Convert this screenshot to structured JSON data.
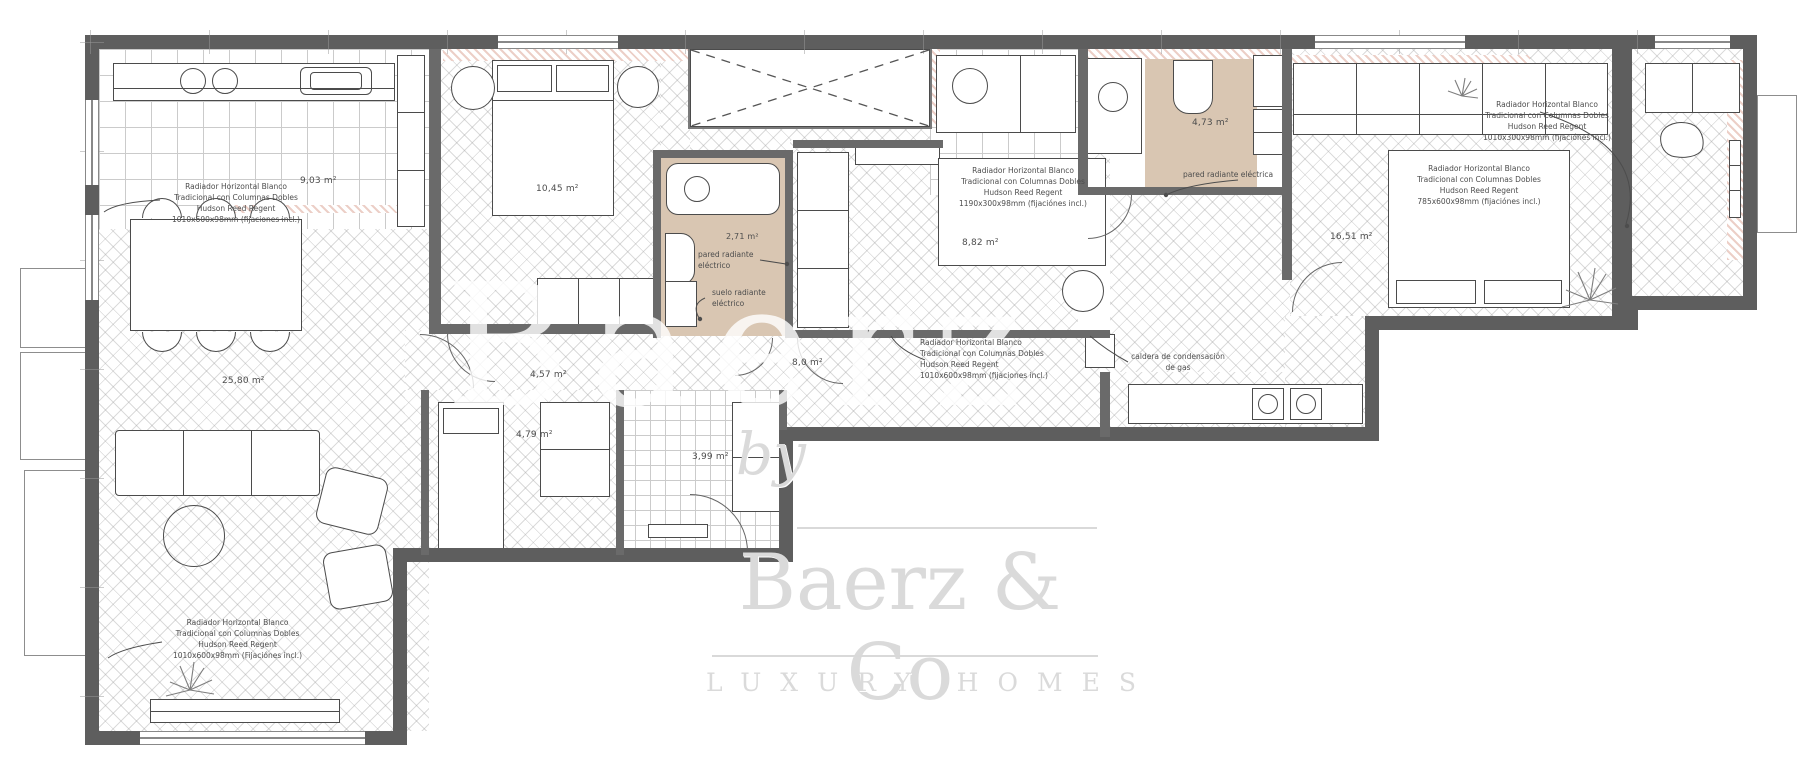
{
  "watermark": {
    "by": "by",
    "name": "Baerz & Co",
    "tagline": "LUXURY HOMES"
  },
  "colors": {
    "wall": "#5e5e5e",
    "bath_floor": "#d9c6b2",
    "new_wall_hatch": "#eccfc7",
    "floor_line": "#cbcbcb",
    "watermark": "#d9d9d9"
  },
  "rooms": {
    "kitchen": {
      "area": "9,03 m²",
      "radiator": "Radiador Horizontal Blanco\nTradicional con Columnas Dobles\nHudson Reed Regent\n1010x600x98mm (fijaciones incl.)"
    },
    "living_room": {
      "area": "25,80 m²",
      "radiator": "Radiador Horizontal Blanco\nTradicional con Columnas Dobles\nHudson Reed Regent\n1010x600x98mm (Fijaciónes incl.)"
    },
    "bedroom_1": {
      "area": "10,45 m²"
    },
    "bathroom_1": {
      "area": "2,71 m²",
      "wall_heating": "pared radiante\neléctrico",
      "floor_heating": "suelo radiante\neléctrico"
    },
    "bedroom_2": {
      "area": "8,82 m²",
      "radiator": "Radiador Horizontal Blanco\nTradicional con Columnas Dobles\nHudson Reed Regent\n1190x300x98mm (fijaciónes incl.)"
    },
    "bathroom_2": {
      "area": "4,73 m²",
      "wall_heating": "pared radiante eléctrica"
    },
    "bedroom_3": {
      "area": "16,51 m²",
      "radiator_wall": "Radiador Horizontal Blanco\nTradicional con Columnas Dobles\nHudson Reed Regent\n1010x300x98mm (fijaciónes incl.)",
      "radiator_bed": "Radiador Horizontal Blanco\nTradicional con Columnas Dobles\nHudson Reed Regent\n785x600x98mm (fijaciónes incl.)"
    },
    "hallway": {
      "area": "4,57 m²",
      "area_2": "8,0 m²",
      "radiator": "Radiador Horizontal Blanco\nTradicional con Columnas Dobles\nHudson Reed Regent\n1010x600x98mm (fijaciones incl.)",
      "boiler": "caldera de condensación\nde gas"
    },
    "inner_hall": {
      "area": "4,79 m²"
    },
    "foyer": {
      "area": "3,99 m²"
    }
  }
}
